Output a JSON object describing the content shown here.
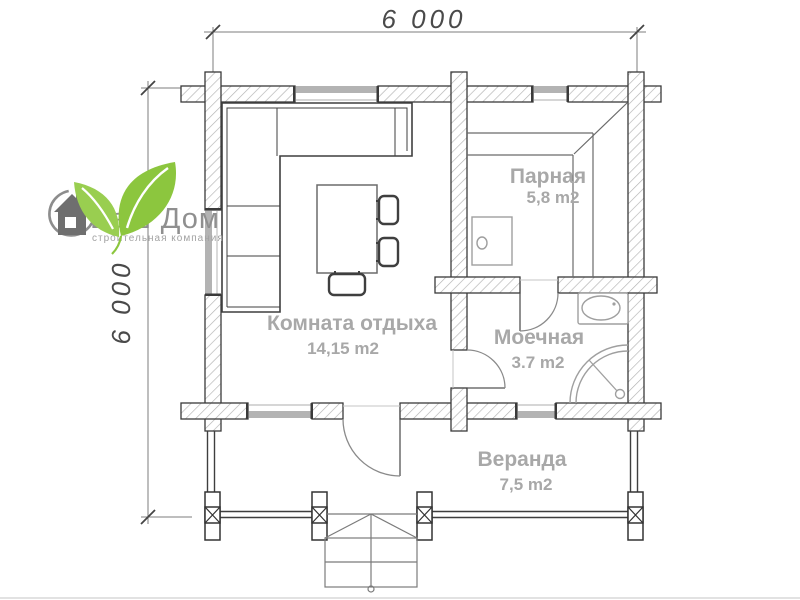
{
  "dimensions": {
    "top": "6 000",
    "left": "6 000",
    "text_color": "#4a4a4a"
  },
  "rooms": {
    "parnaya": {
      "name": "Парная",
      "area": "5,8 m2"
    },
    "komnata": {
      "name": "Комната отдыха",
      "area": "14,15 m2"
    },
    "moechnaya": {
      "name": "Моечная",
      "area": "3.7 m2"
    },
    "veranda": {
      "name": "Веранда",
      "area": "7,5 m2"
    }
  },
  "labels": {
    "color": "#a8a8a8"
  },
  "logo": {
    "title": "Ваш Дом",
    "subtitle": "строительная компания",
    "title_color": "#8f8f8f",
    "subtitle_color": "#a2a2a2",
    "leaf_color": "#8cc63e",
    "leaf_color_2": "#99ce50",
    "house_color": "#6f6f6f"
  },
  "plan": {
    "wall_outline_color": "#3a3a3a",
    "hatch_color": "#b2b2b2",
    "window_color": "#b3b3b3",
    "door_arc_color": "#8a8a8a"
  }
}
